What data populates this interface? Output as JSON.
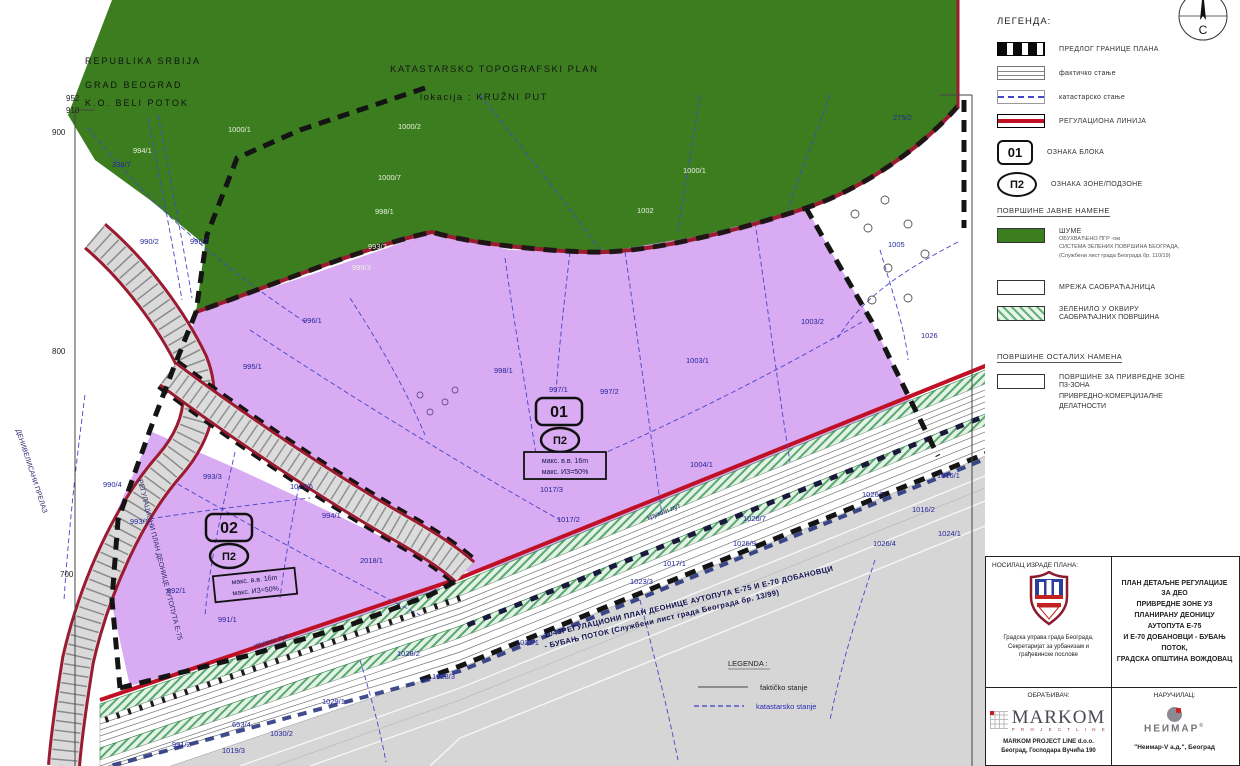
{
  "colors": {
    "forest_green": "#3c7e1f",
    "zone_purple": "#d9abf2",
    "boundary_dark_red": "#9b1b30",
    "regulation_red": "#c01025",
    "cadastre_blue": "#4646c8",
    "hatch_green": "#67b27a",
    "road_gray": "#d6d6d6"
  },
  "map": {
    "header": {
      "line1": "REPUBLIKA SRBIJA",
      "line2": "GRAD BEOGRAD",
      "line3": "K.O. BELI POTOK"
    },
    "title": {
      "line1": "KATASTARSKO TOPOGRAFSKI PLAN",
      "line2": "lokacija : KRUŽNI PUT"
    },
    "blocks": [
      {
        "block": "01",
        "zone": "П2",
        "note1": "макс. в.в. 16m",
        "note2": "макс. ИЗ=50%"
      },
      {
        "block": "02",
        "zone": "П2",
        "note1": "макс. в.в. 16m",
        "note2": "макс. ИЗ=50%"
      }
    ],
    "road_label_line1": "1043РЕГУЛАЦИОНИ ПЛАН ДЕОНИЦЕ АУТОПУТА Е-75 И Е-70 ДОБАНОВЦИ",
    "road_label_line2": "- БУБАЊ ПОТОК (Службени лист града Београда бр. 13/99)",
    "street_label": "кружни пут",
    "left_label": "ДЕНИВЕЛИСАНИ ПРЕЛАЗ",
    "left_road_label": "РЕГУЛАЦИОНИ ПЛАН ДЕОНИЦЕ АУТОПУТА Е-75",
    "mini_legend": {
      "title": "LEGENDA :",
      "item1": "faktičko stanje",
      "item2": "katastarsko stanje"
    },
    "axis": [
      {
        "n": "952",
        "x": 66,
        "y": 101
      },
      {
        "n": "910",
        "x": 66,
        "y": 113
      },
      {
        "n": "900",
        "x": 52,
        "y": 135
      },
      {
        "n": "800",
        "x": 52,
        "y": 354
      },
      {
        "n": "700",
        "x": 60,
        "y": 577
      }
    ],
    "parcels": [
      {
        "n": "1000/1",
        "x": 228,
        "y": 132,
        "c": "g"
      },
      {
        "n": "1000/2",
        "x": 398,
        "y": 129,
        "c": "g"
      },
      {
        "n": "1000/7",
        "x": 378,
        "y": 180,
        "c": "g"
      },
      {
        "n": "994/1",
        "x": 133,
        "y": 153,
        "c": "g"
      },
      {
        "n": "998/1",
        "x": 375,
        "y": 214,
        "c": "g"
      },
      {
        "n": "993/2",
        "x": 368,
        "y": 249,
        "c": "g"
      },
      {
        "n": "999/3",
        "x": 352,
        "y": 270,
        "c": "g"
      },
      {
        "n": "1000/1",
        "x": 683,
        "y": 173,
        "c": "g"
      },
      {
        "n": "1002",
        "x": 637,
        "y": 213,
        "c": "g"
      },
      {
        "n": "275/2",
        "x": 893,
        "y": 120
      },
      {
        "n": "1005",
        "x": 888,
        "y": 247,
        "s": 9
      },
      {
        "n": "1026",
        "x": 921,
        "y": 338,
        "s": 9
      },
      {
        "n": "336/7",
        "x": 112,
        "y": 167
      },
      {
        "n": "990/2",
        "x": 140,
        "y": 244
      },
      {
        "n": "996/2",
        "x": 190,
        "y": 244
      },
      {
        "n": "996/1",
        "x": 303,
        "y": 323
      },
      {
        "n": "995/1",
        "x": 243,
        "y": 369,
        "s": 9
      },
      {
        "n": "998/1",
        "x": 494,
        "y": 373
      },
      {
        "n": "997/1",
        "x": 549,
        "y": 392
      },
      {
        "n": "997/2",
        "x": 600,
        "y": 394
      },
      {
        "n": "1003/1",
        "x": 686,
        "y": 363,
        "s": 9
      },
      {
        "n": "1003/2",
        "x": 801,
        "y": 324,
        "s": 9
      },
      {
        "n": "1004/1",
        "x": 690,
        "y": 467
      },
      {
        "n": "1017/3",
        "x": 540,
        "y": 492
      },
      {
        "n": "1017/2",
        "x": 557,
        "y": 522
      },
      {
        "n": "1017/1",
        "x": 663,
        "y": 566
      },
      {
        "n": "1023/3",
        "x": 630,
        "y": 584
      },
      {
        "n": "1016/1",
        "x": 937,
        "y": 478
      },
      {
        "n": "1016/2",
        "x": 912,
        "y": 512
      },
      {
        "n": "1026/5",
        "x": 862,
        "y": 497,
        "s": 9
      },
      {
        "n": "1026/7",
        "x": 743,
        "y": 521,
        "s": 9
      },
      {
        "n": "1026/9",
        "x": 733,
        "y": 546
      },
      {
        "n": "1026/4",
        "x": 873,
        "y": 546,
        "s": 9
      },
      {
        "n": "1024/1",
        "x": 938,
        "y": 536
      },
      {
        "n": "993/3",
        "x": 203,
        "y": 479
      },
      {
        "n": "1017/6",
        "x": 290,
        "y": 489
      },
      {
        "n": "994/1",
        "x": 322,
        "y": 518
      },
      {
        "n": "993/1",
        "x": 130,
        "y": 524
      },
      {
        "n": "2018/1",
        "x": 360,
        "y": 563
      },
      {
        "n": "992/1",
        "x": 167,
        "y": 593
      },
      {
        "n": "991/1",
        "x": 218,
        "y": 622
      },
      {
        "n": "990/4",
        "x": 103,
        "y": 487
      },
      {
        "n": "1022/1",
        "x": 516,
        "y": 645
      },
      {
        "n": "1028/2",
        "x": 397,
        "y": 656
      },
      {
        "n": "1028/3",
        "x": 432,
        "y": 679
      },
      {
        "n": "1029/1",
        "x": 322,
        "y": 704,
        "s": 9
      },
      {
        "n": "653/4",
        "x": 232,
        "y": 727
      },
      {
        "n": "1030/2",
        "x": 270,
        "y": 736
      },
      {
        "n": "1019/3",
        "x": 222,
        "y": 753
      },
      {
        "n": "991/2",
        "x": 172,
        "y": 747
      }
    ]
  },
  "legend": {
    "title": "ЛЕГЕНДА:",
    "compass_label": "С",
    "items": [
      {
        "label": "ПРЕДЛОГ ГРАНИЦЕ ПЛАНА"
      },
      {
        "label": "фактичко стање"
      },
      {
        "label": "катастарско стање"
      },
      {
        "label": "РЕГУЛАЦИОНА ЛИНИЈА"
      },
      {
        "symbol": "01",
        "label": "ОЗНАКА БЛОКА"
      },
      {
        "symbol": "П2",
        "label": "ОЗНАКА ЗОНЕ/ПОДЗОНЕ"
      }
    ],
    "section_public": "ПОВРШИНЕ ЈАВНЕ НАМЕНЕ",
    "public_items": [
      {
        "label": "ШУМЕ",
        "sub": [
          "ОБУХВАЋЕНО ПГР -ом",
          "СИСТЕМА ЗЕЛЕНИХ ПОВРШИНА БЕОГРАДА,",
          "(Службени лист града Београда бр. 110/19)"
        ]
      },
      {
        "label": "МРЕЖА САОБРАЋАЈНИЦА"
      },
      {
        "label": "ЗЕЛЕНИЛО У ОКВИРУ",
        "label2": "САОБРАЋАЈНИХ ПОВРШИНА"
      }
    ],
    "section_other": "ПОВРШИНЕ ОСТАЛИХ НАМЕНА",
    "other_item": {
      "lines": [
        "ПОВРШИНЕ ЗА ПРИВРЕДНЕ ЗОНЕ",
        "П3-ЗОНА",
        "ПРИВРЕДНО-КОМЕРЦИЈАЛНЕ",
        "ДЕЛАТНОСТИ"
      ]
    }
  },
  "titleblock": {
    "holder_label": "НОСИЛАЦ ИЗРАДЕ ПЛАНА:",
    "holder_lines": [
      "Градска управа града Београда,",
      "Секретаријат за урбанизам и",
      "грађевинске послове"
    ],
    "plan_title_lines": [
      "ПЛАН ДЕТАЉНЕ РЕГУЛАЦИЈЕ ЗА ДЕО",
      "ПРИВРЕДНЕ ЗОНЕ УЗ",
      "ПЛАНИРАНУ ДЕОНИЦУ АУТОПУТА Е-75",
      "И Е-70 ДОБАНОВЦИ - БУБАЊ ПОТОК,",
      "ГРАДСКА ОПШТИНА ВОЖДОВАЦ"
    ],
    "designer_label": "ОБРАЂИВАЧ:",
    "designer_logo": "MARKOM",
    "designer_logo_sub": "P R O J E C T   L I N E",
    "designer_lines": [
      "MARKOM PROJECT LINE d.o.o.",
      "Београд, Господара Вучића 190"
    ],
    "client_label": "НАРУЧИЛАЦ:",
    "client_logo": "НЕИМАР",
    "client_logo_mark": "®",
    "client_line": "\"Неимар-V а.д.\", Београд"
  }
}
